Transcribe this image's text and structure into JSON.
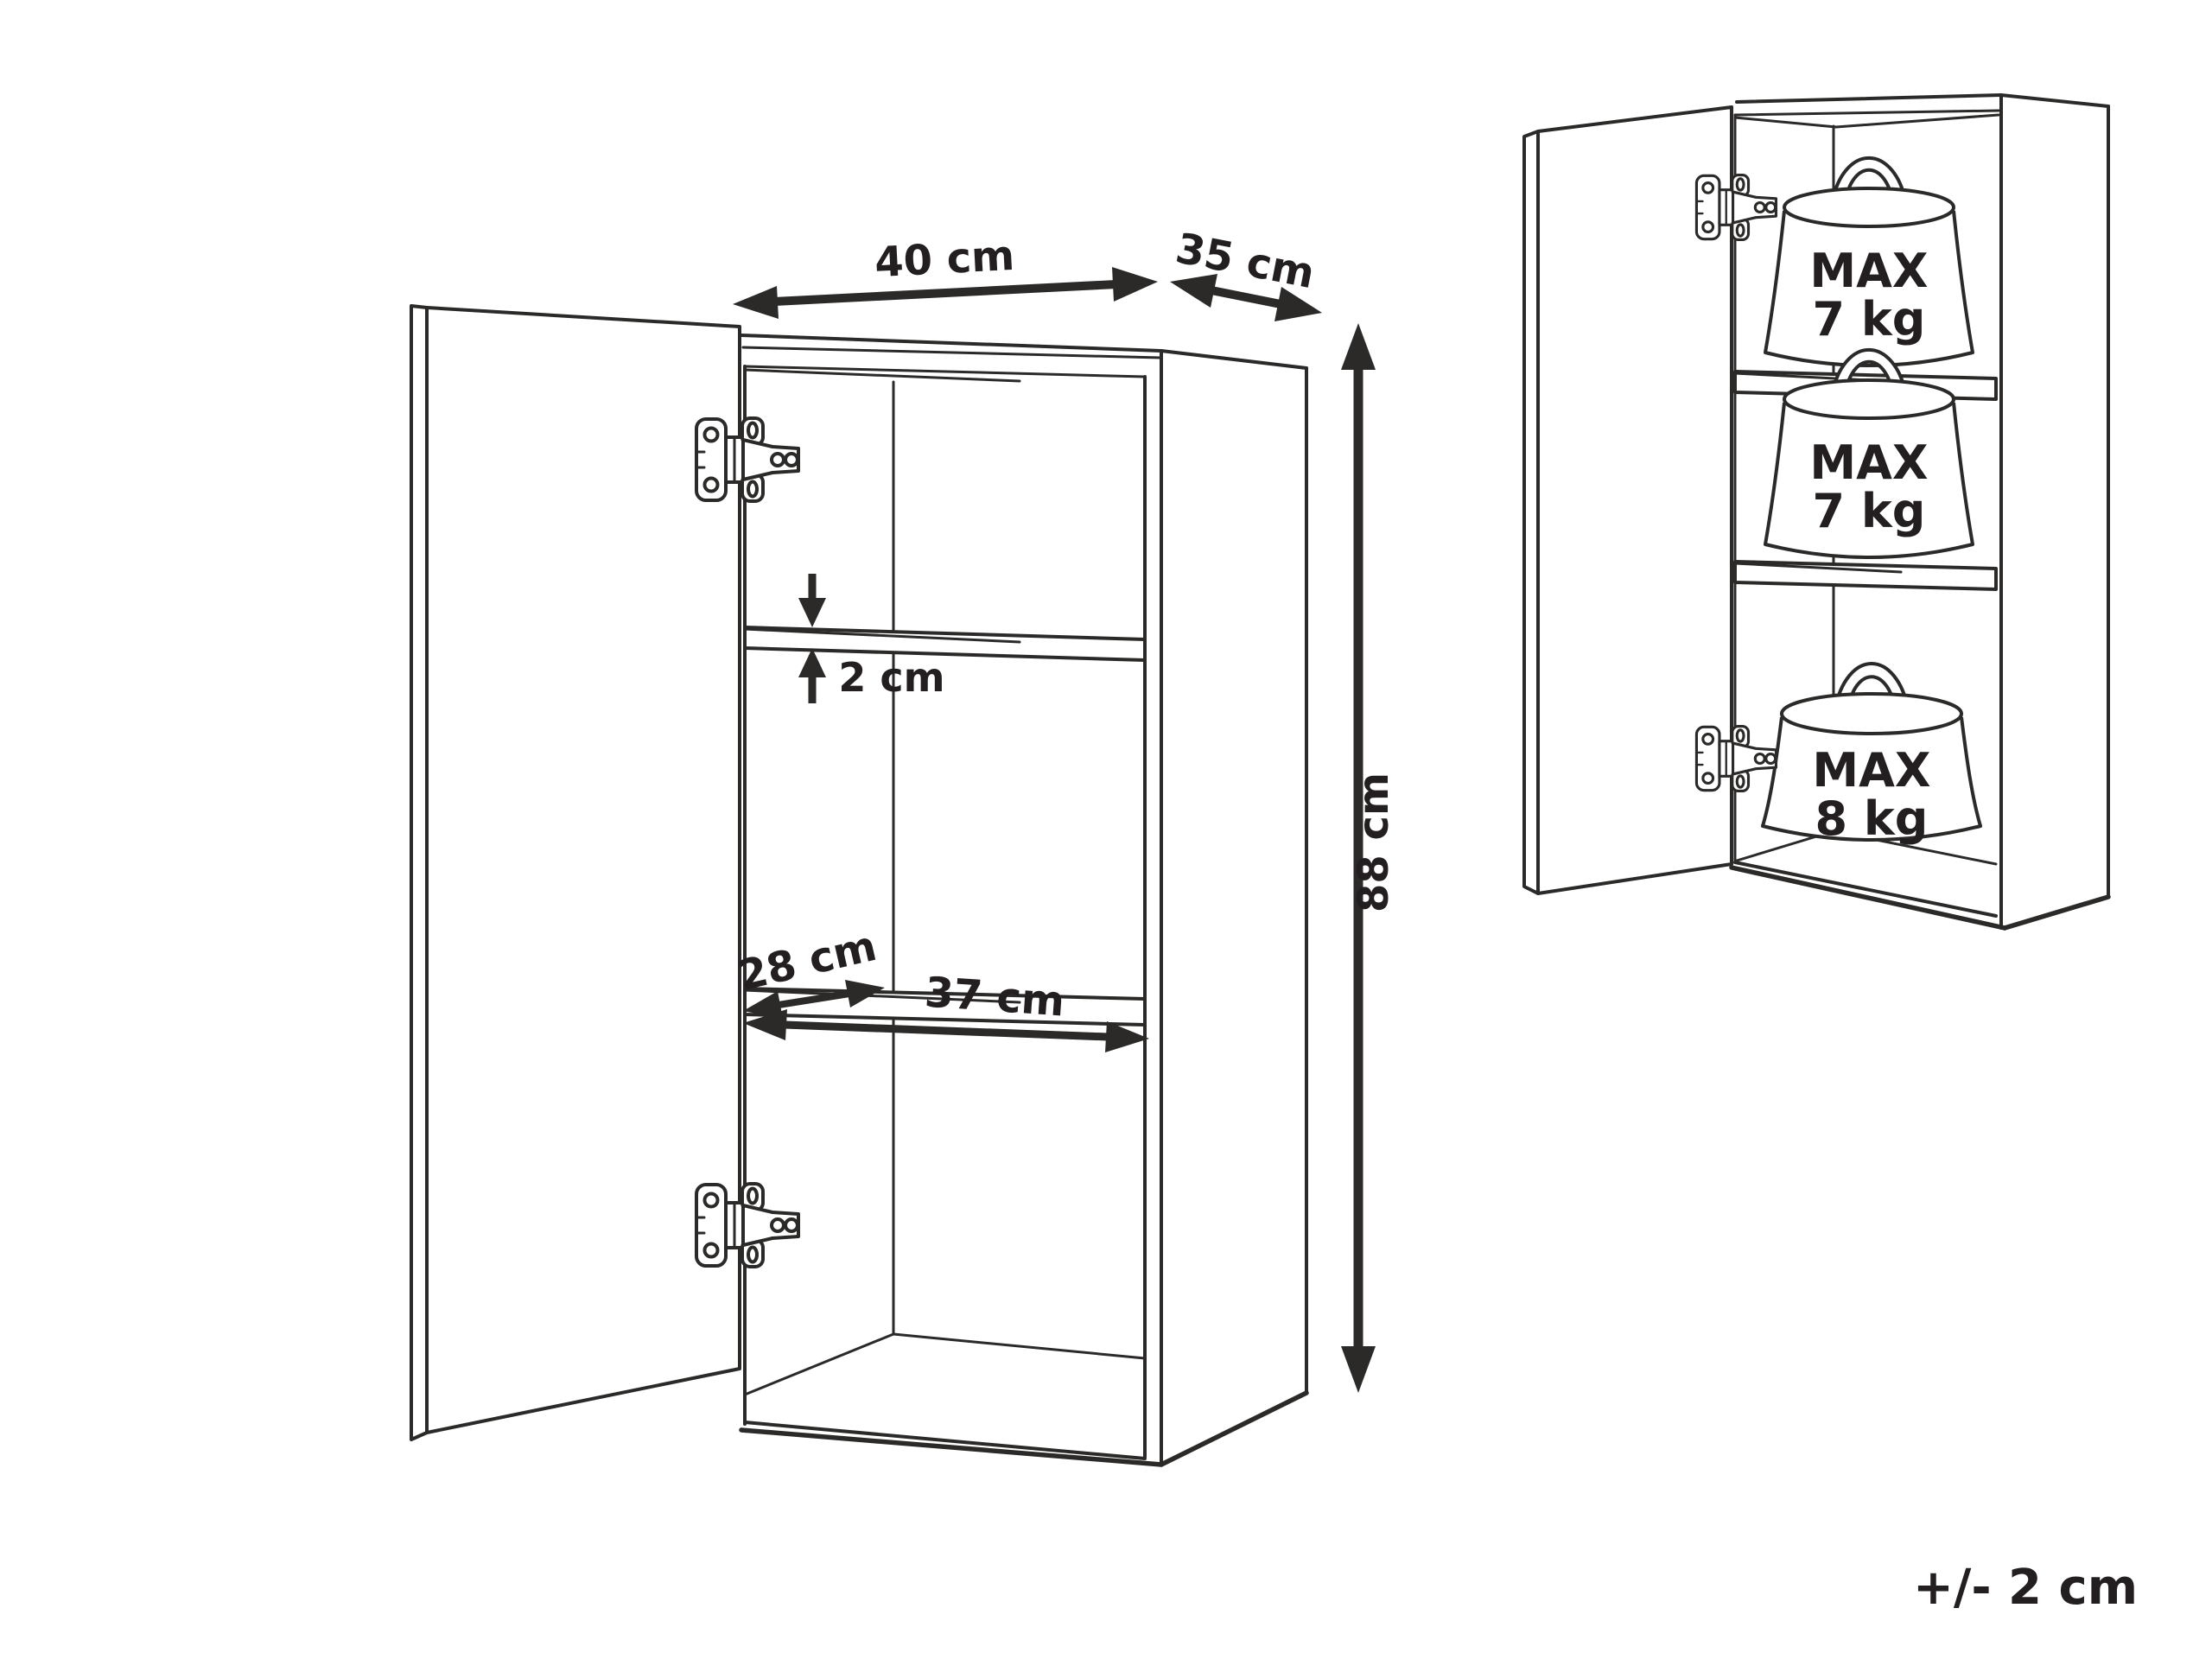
{
  "colors": {
    "background": "#ffffff",
    "line": "#2b2a29",
    "text": "#231f20"
  },
  "dimension_view": {
    "width_label": "40 cm",
    "depth_label": "35 cm",
    "height_label": "88 cm",
    "shelf_thickness_label": "2 cm",
    "shelf_depth_label": "28 cm",
    "shelf_width_label": "37 cm"
  },
  "load_capacity_view": {
    "shelf_loads": [
      {
        "line1": "MAX",
        "line2": "7 kg"
      },
      {
        "line1": "MAX",
        "line2": "7 kg"
      },
      {
        "line1": "MAX",
        "line2": "8 kg"
      }
    ]
  },
  "tolerance_note": "+/- 2 cm"
}
